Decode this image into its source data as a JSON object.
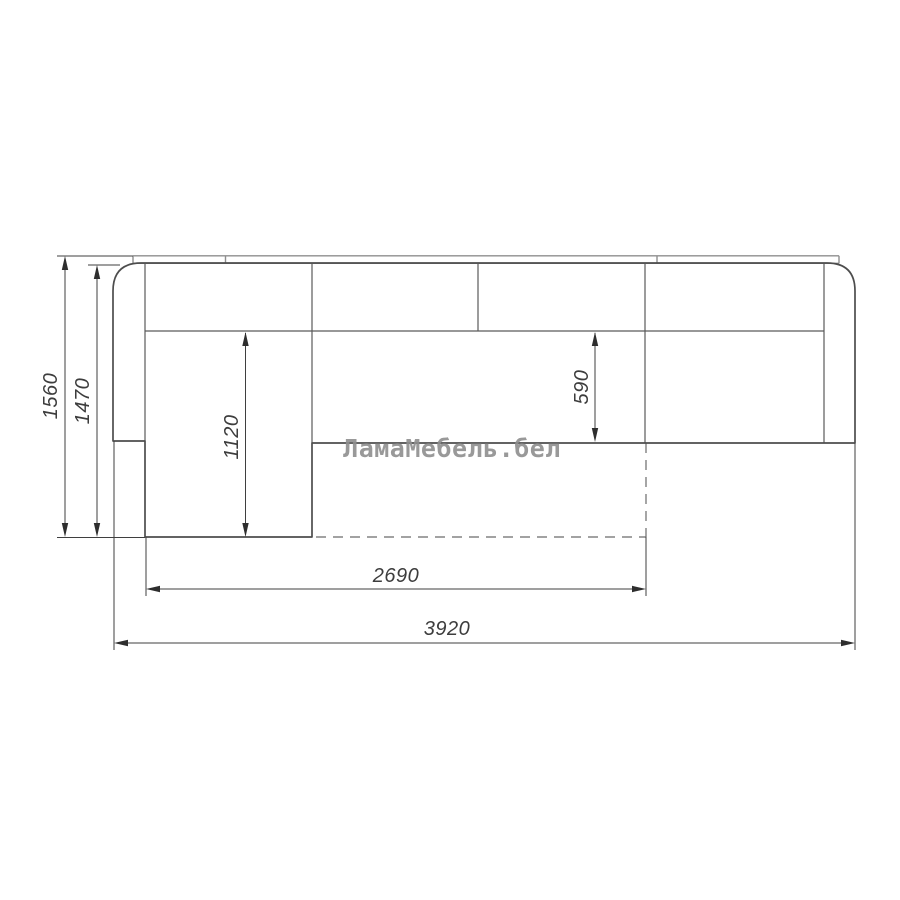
{
  "drawing": {
    "dimensions": {
      "width_total": "3920",
      "width_bed_extension": "2690",
      "depth_total": "1560",
      "depth_body": "1470",
      "chaise_length": "1120",
      "seat_depth": "590"
    },
    "watermark": {
      "text": "ЛамаМебель.бел",
      "color": "#8f8f8f"
    },
    "colors": {
      "background": "#ffffff",
      "outline": "#4d4d4d",
      "inner_lines": "#5a5a5a",
      "back_panel_strip": "#8e8e8e",
      "dashed_bed_outline": "#6a6a6a",
      "dimension_lines": "#3f3f3f",
      "dimension_text": "#3d3d3d"
    }
  }
}
